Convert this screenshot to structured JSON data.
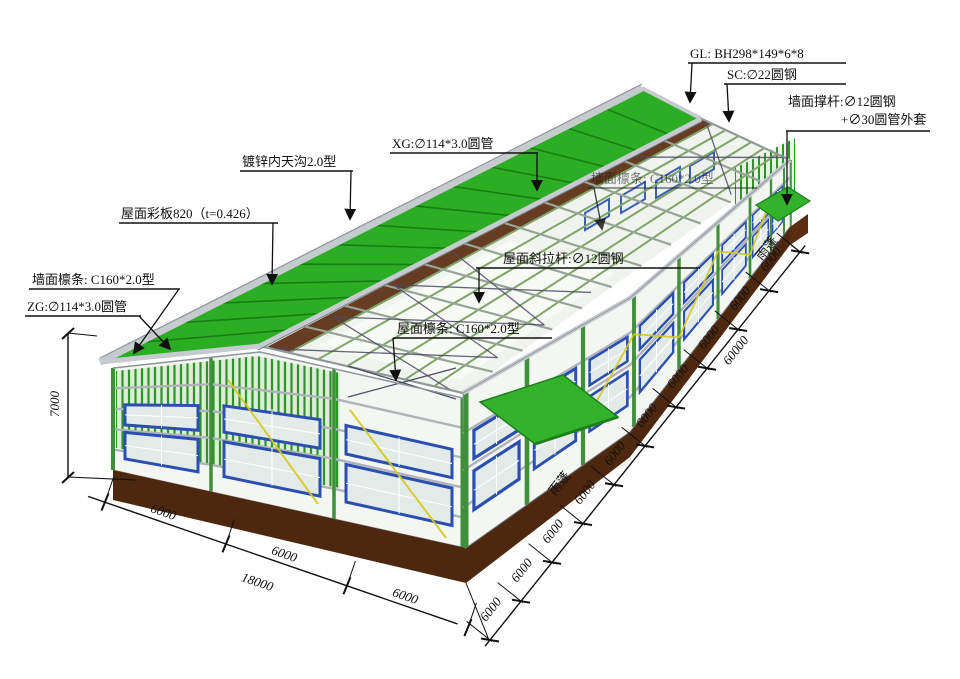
{
  "drawing": {
    "type": "steel-structure-workshop-axonometric",
    "labels": {
      "gl": "GL: BH298*149*6*8",
      "sc": "SC:∅22圆钢",
      "wall_strut_1": "墙面撑杆:∅12圆钢",
      "wall_strut_2": "+∅30圆管外套",
      "xg": "XG:∅114*3.0圆管",
      "far_wall_purlin": "墙面檩条: C160*2.0型",
      "roof_diagonal_tie": "屋面斜拉杆:∅12圆钢",
      "roof_purlin": "屋面檩条: C160*2.0型",
      "gutter": "镀锌内天沟2.0型",
      "roof_panel": "屋面彩板820（t=0.426）",
      "gable_wall_purlin": "墙面檩条: C160*2.0型",
      "zg": "ZG:∅114*3.0圆管",
      "canopy_top": "雨蓬",
      "canopy_bottom": "雨蓬"
    },
    "dimensions": {
      "height": "7000",
      "gable_chain": {
        "segments": [
          "6000",
          "6000",
          "6000"
        ],
        "total": "18000"
      },
      "side_chain": {
        "segments": [
          "6000",
          "6000",
          "6000",
          "6000",
          "6000",
          "6000",
          "6000",
          "6000",
          "6000",
          "6000"
        ],
        "total": "60000"
      }
    },
    "colors": {
      "roof_green": "#2BAD24",
      "seam_green": "#157415",
      "frame_green": "#3F8F3B",
      "slat_green": "#2E9429",
      "window_blue": "#2A4FB0",
      "glass": "#E3EBE8",
      "base_brown": "#4E280E",
      "floor_brown": "#5A2D10",
      "trim_gray": "#C6CBCF",
      "girt_gray": "#AEB4B9",
      "brace_yellow": "#D4C822",
      "brace_dark": "#4E4A66",
      "ink": "#101010"
    }
  }
}
